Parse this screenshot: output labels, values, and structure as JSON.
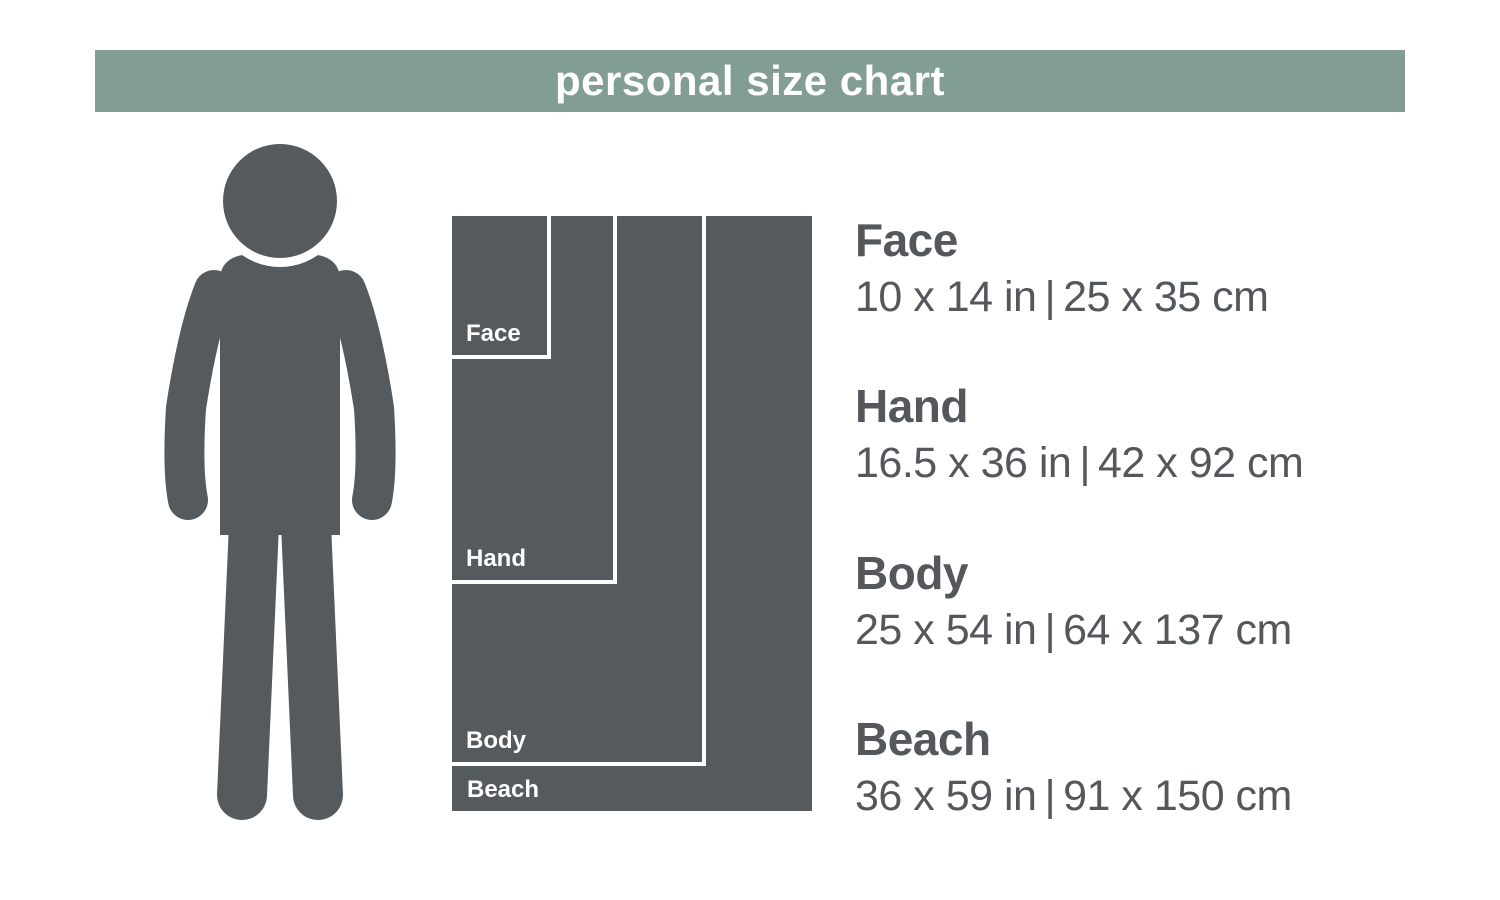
{
  "banner": {
    "title": "personal size chart"
  },
  "colors": {
    "banner_green": "#829e92",
    "dark_gray": "#545a5e",
    "text_gray": "#54585c",
    "white": "#ffffff"
  },
  "person": {
    "icon": "person-silhouette"
  },
  "sizes": [
    {
      "id": "face",
      "label": "Face",
      "inches": "10 x 14 in",
      "separator": "|",
      "cm": "25 x 35 cm"
    },
    {
      "id": "hand",
      "label": "Hand",
      "inches": "16.5 x 36 in",
      "separator": "|",
      "cm": "42 x 92 cm"
    },
    {
      "id": "body",
      "label": "Body",
      "inches": "25 x 54 in",
      "separator": "|",
      "cm": "64 x 137 cm"
    },
    {
      "id": "beach",
      "label": "Beach",
      "inches": "36 x 59 in",
      "separator": "|",
      "cm": "91 x 150 cm"
    }
  ],
  "chart_data": {
    "type": "table",
    "title": "personal size chart",
    "categories": [
      "Face",
      "Hand",
      "Body",
      "Beach"
    ],
    "series": [
      {
        "name": "width_in",
        "values": [
          10,
          16.5,
          25,
          36
        ]
      },
      {
        "name": "height_in",
        "values": [
          14,
          36,
          54,
          59
        ]
      },
      {
        "name": "width_cm",
        "values": [
          25,
          42,
          64,
          91
        ]
      },
      {
        "name": "height_cm",
        "values": [
          35,
          92,
          137,
          150
        ]
      }
    ],
    "layout": "nested rectangles drawn to scale (~10 px per inch), anchored top-left, beside human figure for scale"
  }
}
